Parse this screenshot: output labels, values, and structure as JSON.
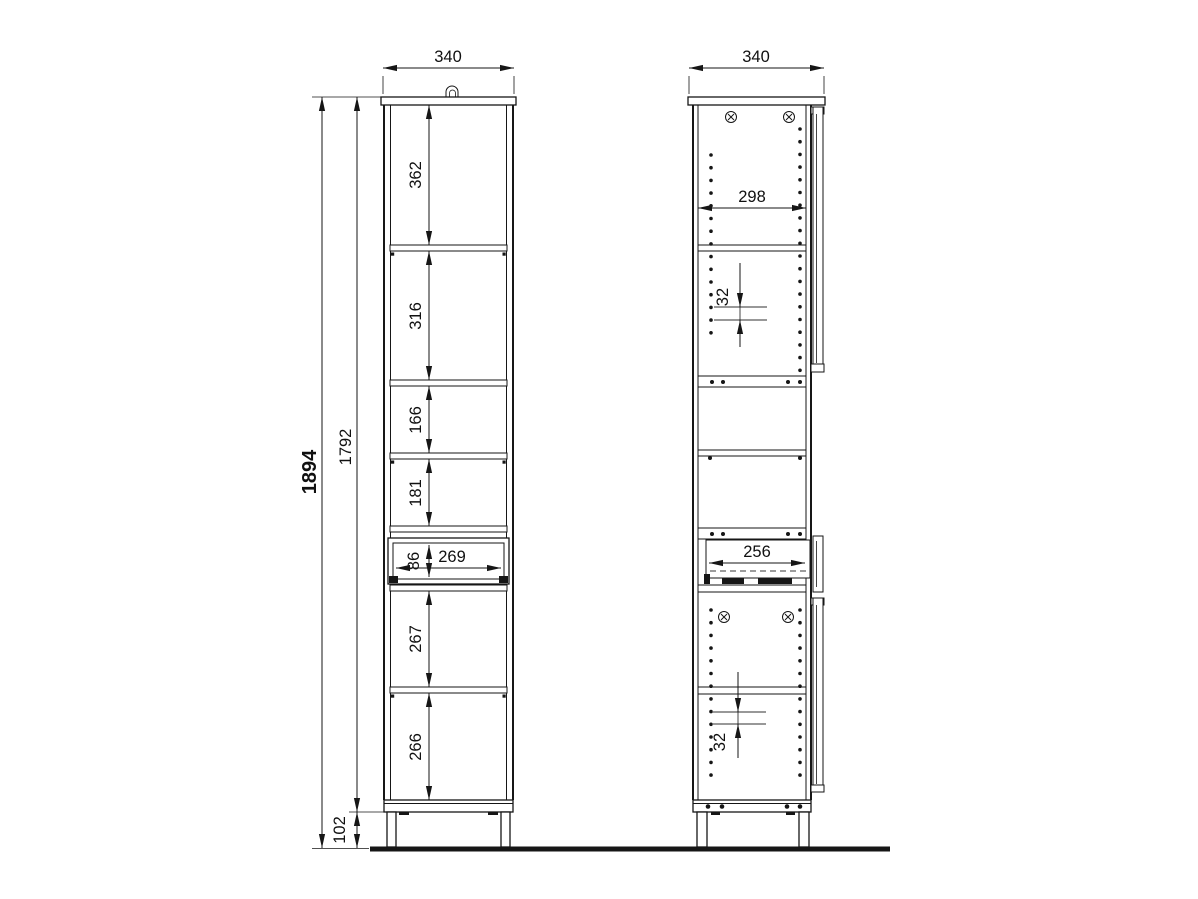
{
  "drawing": {
    "background_color": "#ffffff",
    "line_color": "#161616",
    "front_view": {
      "width": "340",
      "total_height": "1894",
      "interior_height": "1792",
      "leg_height": "102",
      "compartments": [
        "362",
        "316",
        "166",
        "181"
      ],
      "drawer_height": "86",
      "drawer_inner_width": "269",
      "lower_compartments": [
        "267",
        "266"
      ]
    },
    "side_view": {
      "width": "340",
      "interior_depth": "298",
      "hole_pitch_top": "32",
      "drawer_depth": "256",
      "hole_pitch_bottom": "32"
    }
  }
}
